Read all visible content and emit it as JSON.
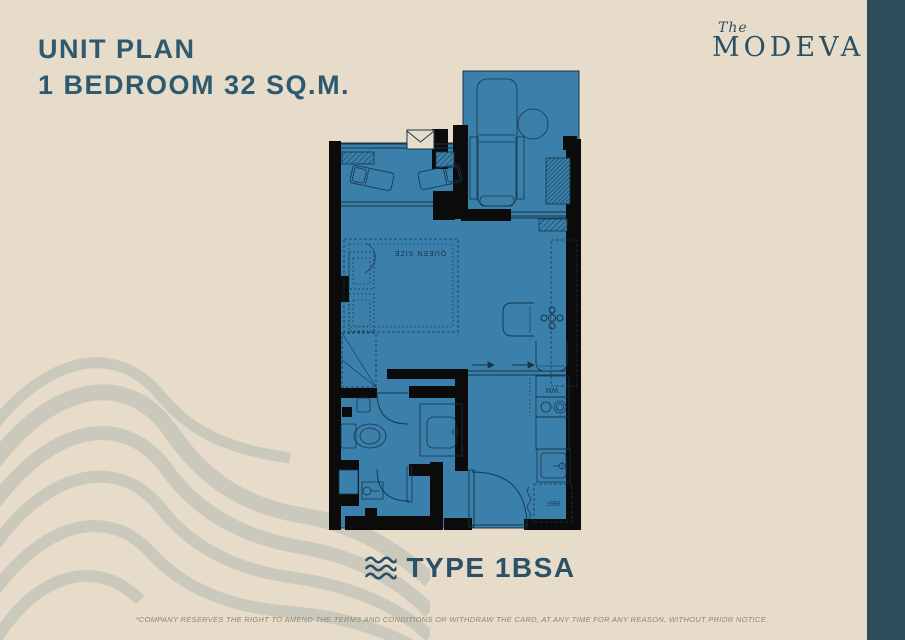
{
  "page": {
    "bg_color": "#e6dcc9",
    "side_band_color": "#2b4c59",
    "accent_color": "#2d5a70"
  },
  "header": {
    "title_line1": "UNIT PLAN",
    "title_line2": "1 BEDROOM 32 SQ.M."
  },
  "logo": {
    "prefix": "The",
    "name": "MODEVA"
  },
  "floor_plan": {
    "floor_color": "#3a80aa",
    "wall_color": "#0b0b0b",
    "line_color": "#17344a",
    "labels": {
      "bed": "QUEEN SIZE",
      "washer": "WM",
      "fridge": "REF."
    }
  },
  "type_label": {
    "text": "TYPE 1BSA",
    "icon": "wave-icon"
  },
  "footer": {
    "disclaimer": "*COMPANY RESERVES THE RIGHT TO AMEND THE TERMS AND CONDITIONS OR WITHDRAW THE CARD, AT ANY TIME FOR ANY REASON, WITHOUT PRIOR NOTICE."
  }
}
